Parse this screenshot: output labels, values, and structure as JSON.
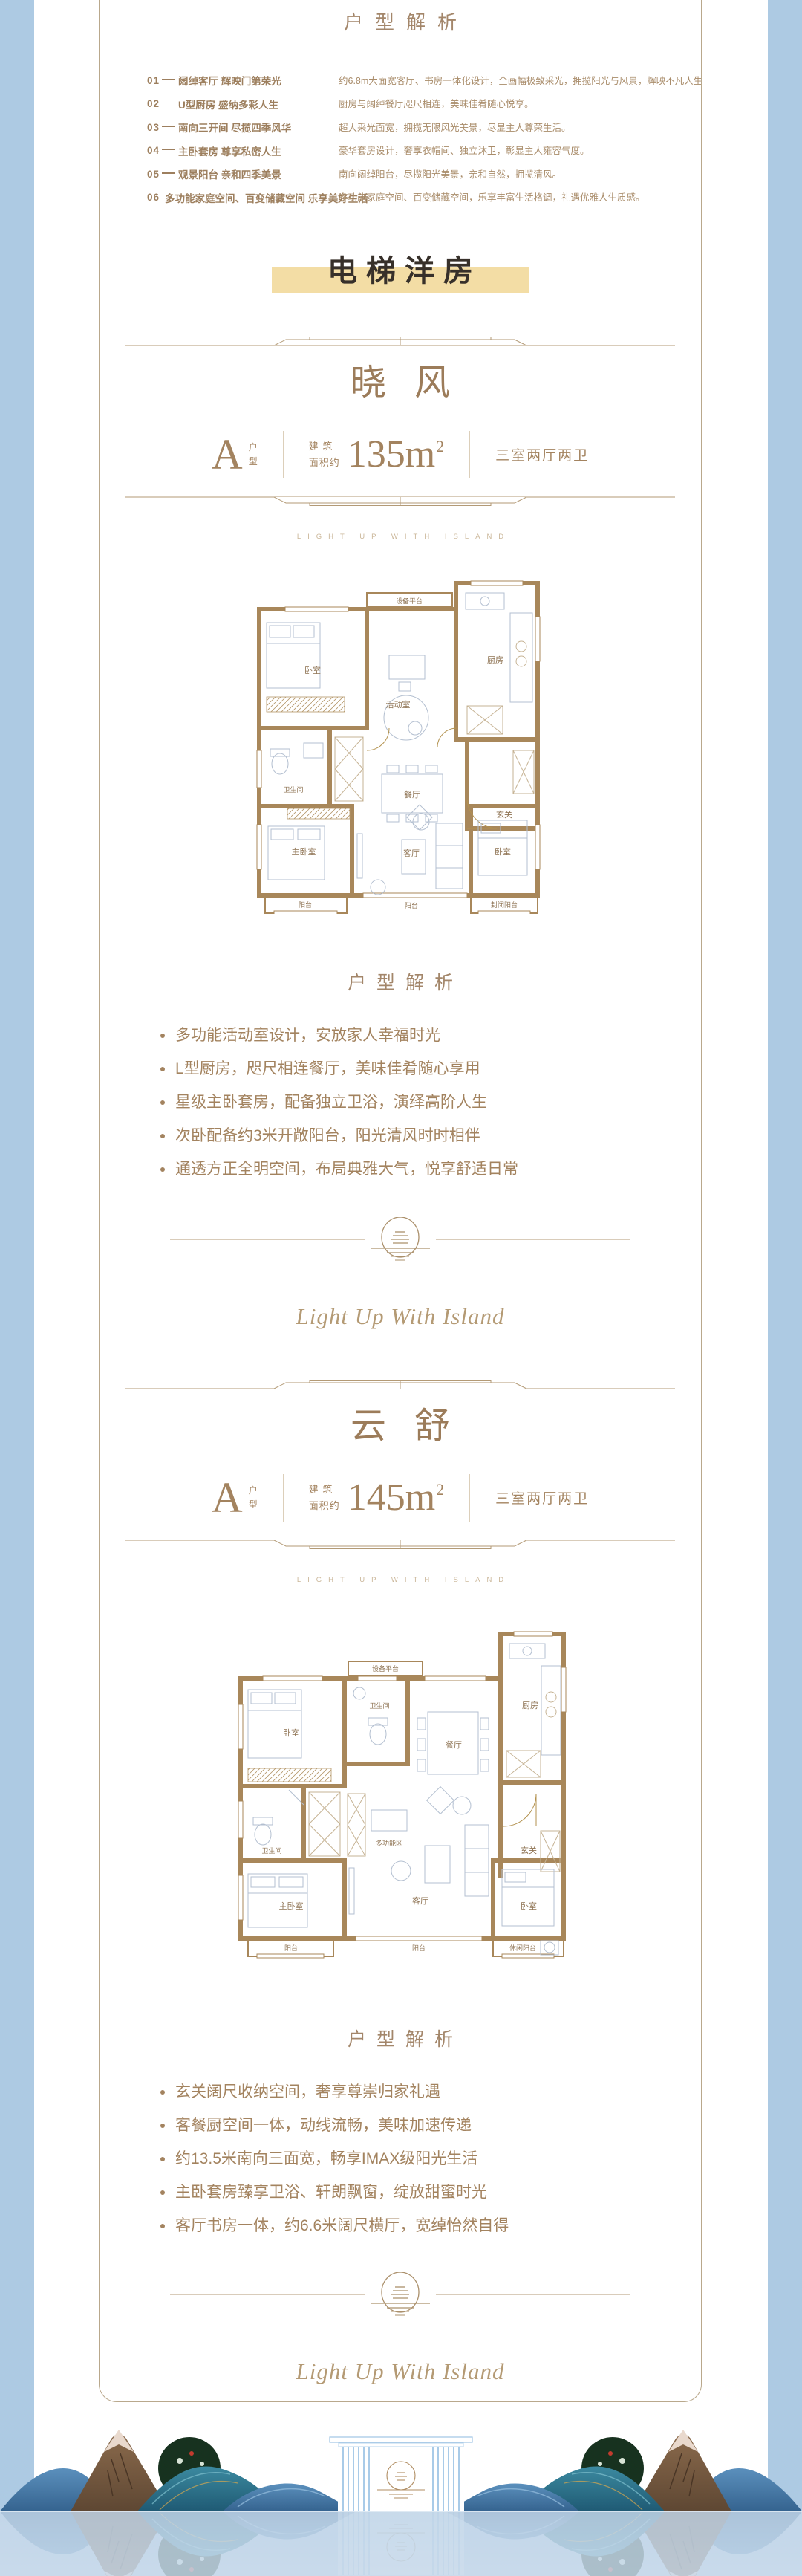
{
  "colors": {
    "side_blue": "#adcae3",
    "water_blue": "#c9daeb",
    "gold_bar": "#f3dda5",
    "brown_text": "#a3835f",
    "wall_brown": "#a8875a"
  },
  "top_analysis": {
    "title": "户型解析",
    "rows": [
      {
        "num": "01",
        "title": "阔绰客厅 辉映门第荣光",
        "desc": "约6.8m大面宽客厅、书房一体化设计，全画幅极致采光，拥揽阳光与风景，辉映不凡人生。"
      },
      {
        "num": "02",
        "title": "U型厨房 盛纳多彩人生",
        "desc": "厨房与阔绰餐厅咫尺相连，美味佳肴随心悦享。"
      },
      {
        "num": "03",
        "title": "南向三开间 尽揽四季风华",
        "desc": "超大采光面宽，拥揽无限风光美景，尽显主人尊荣生活。"
      },
      {
        "num": "04",
        "title": "主卧套房 尊享私密人生",
        "desc": "豪华套房设计，奢享衣帽间、独立沐卫，彰显主人雍容气度。"
      },
      {
        "num": "05",
        "title": "观景阳台 亲和四季美景",
        "desc": "南向阔绰阳台，尽揽阳光美景，亲和自然，拥揽清风。"
      },
      {
        "num": "06",
        "title": "多功能家庭空间、百变储藏空间 乐享美好生活",
        "desc": "多功能家庭空间、百变储藏空间，乐享丰富生活格调，礼遇优雅人生质感。"
      }
    ]
  },
  "banner": {
    "label": "电梯洋房"
  },
  "sections": [
    {
      "title": "晓风",
      "unit": {
        "letter": "A",
        "word_top": "户",
        "word_bottom": "型",
        "area_prefix_1": "建 筑",
        "area_prefix_2": "面积约",
        "area": "135m",
        "area_sup": "2",
        "rooms_text": "三室两厅两卫"
      },
      "tagline": "LIGHT UP WITH ISLAND",
      "analysis_title": "户型解析",
      "bullets": [
        "多功能活动室设计，安放家人幸福时光",
        "L型厨房，咫尺相连餐厅，美味佳肴随心享用",
        "星级主卧套房，配备独立卫浴，演绎高阶人生",
        "次卧配备约3米开敞阳台，阳光清风时时相伴",
        "通透方正全明空间，布局典雅大气，悦享舒适日常"
      ],
      "plan": {
        "platform": "设备平台",
        "bedroom_top": "卧室",
        "activity": "活动室",
        "kitchen": "厨房",
        "bath": "卫生间",
        "dining": "餐厅",
        "foyer": "玄关",
        "master": "主卧室",
        "balcony_left": "阳台",
        "living": "客厅",
        "balcony_center": "阳台",
        "bedroom_right": "卧室",
        "balcony_enclosed": "封闭阳台"
      }
    },
    {
      "title": "云舒",
      "unit": {
        "letter": "A",
        "word_top": "户",
        "word_bottom": "型",
        "area_prefix_1": "建 筑",
        "area_prefix_2": "面积约",
        "area": "145m",
        "area_sup": "2",
        "rooms_text": "三室两厅两卫"
      },
      "tagline": "LIGHT UP WITH ISLAND",
      "analysis_title": "户型解析",
      "bullets": [
        "玄关阔尺收纳空间，奢享尊崇归家礼遇",
        "客餐厨空间一体，动线流畅，美味加速传递",
        "约13.5米南向三面宽，畅享IMAX级阳光生活",
        "主卧套房臻享卫浴、轩朗飘窗，绽放甜蜜时光",
        "客厅书房一体，约6.6米阔尺横厅，宽绰怡然自得"
      ],
      "plan": {
        "platform": "设备平台",
        "bedroom_top": "卧室",
        "bath_top": "卫生间",
        "dining": "餐厅",
        "kitchen": "厨房",
        "foyer": "玄关",
        "bath_left": "卫生间",
        "master": "主卧室",
        "multi": "多功能区",
        "living": "客厅",
        "balcony_left": "阳台",
        "balcony_center": "阳台",
        "bedroom_right": "卧室",
        "balcony_leisure": "休闲阳台"
      }
    }
  ],
  "script_text": "Light Up With Island"
}
